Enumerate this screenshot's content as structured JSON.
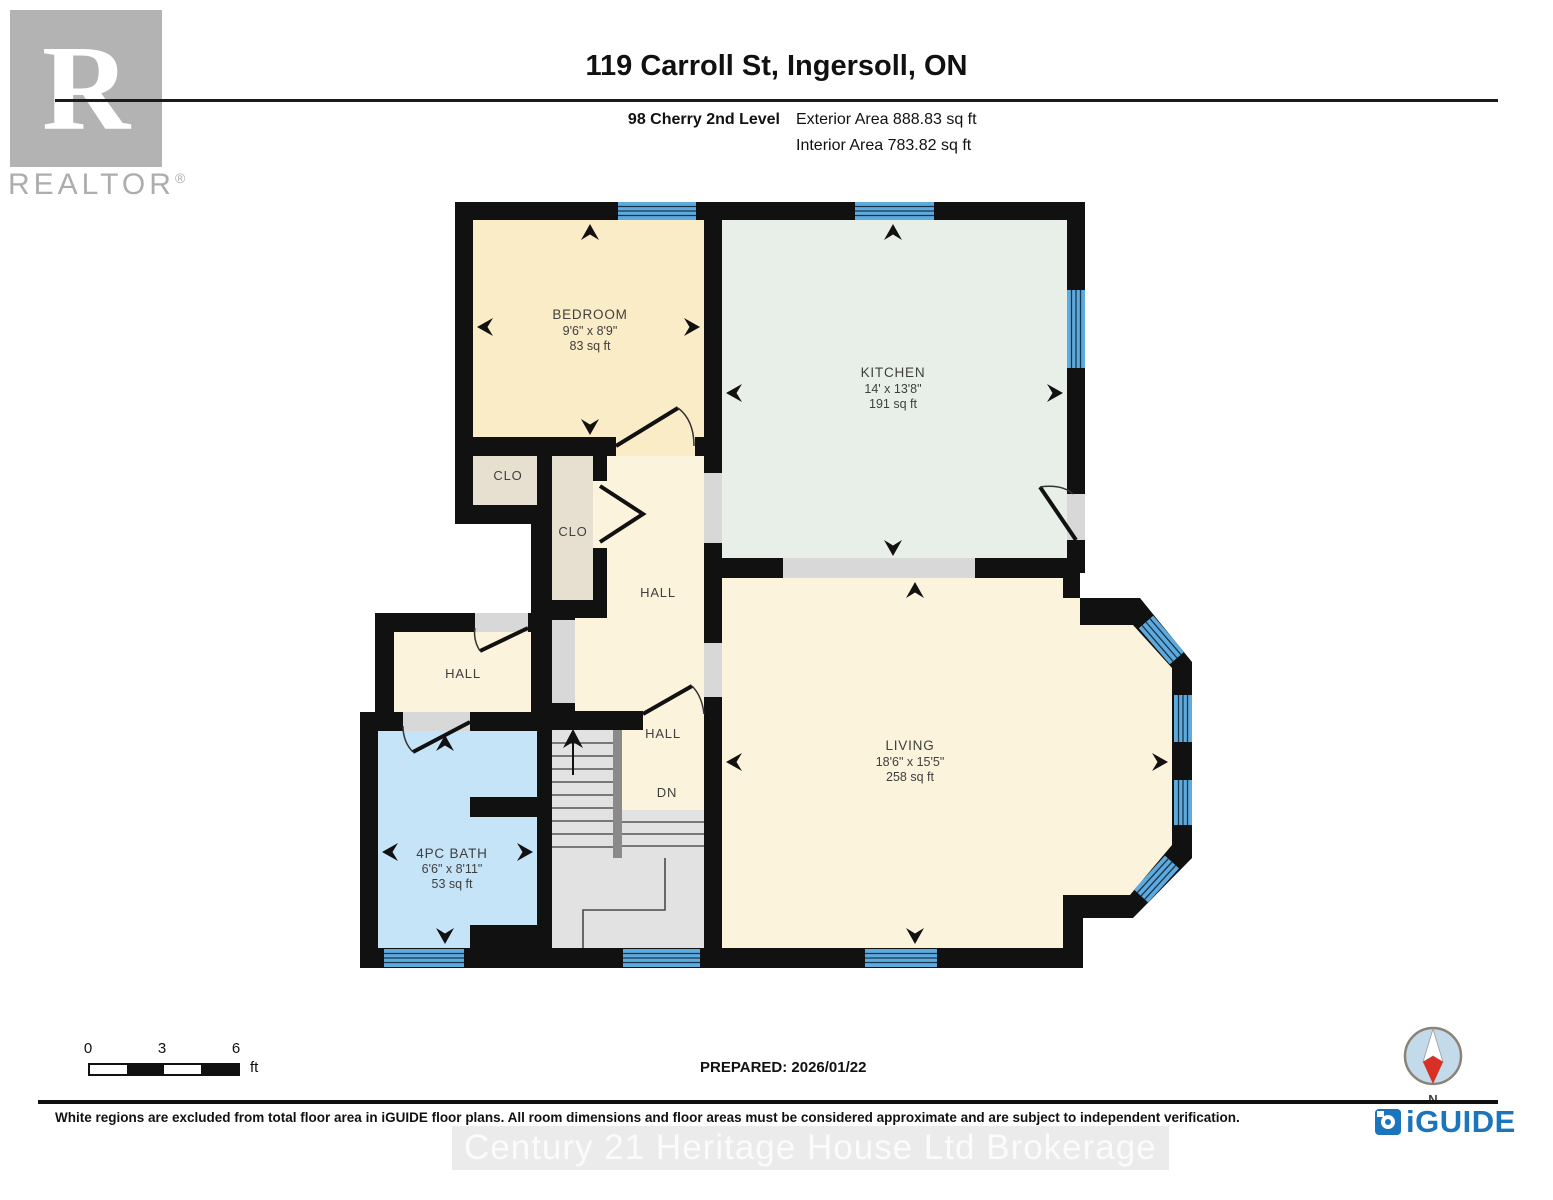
{
  "header": {
    "title": "119 Carroll St, Ingersoll, ON",
    "floor_label": "98 Cherry 2nd Level",
    "exterior_area": "Exterior Area 888.83 sq ft",
    "interior_area": "Interior Area 783.82 sq ft",
    "realtor_logo_letter": "R",
    "realtor_logo_text": "REALTOR",
    "registered_mark": "®"
  },
  "rooms": {
    "bedroom": {
      "name": "BEDROOM",
      "dims": "9'6\" x 8'9\"",
      "area": "83 sq ft"
    },
    "kitchen": {
      "name": "KITCHEN",
      "dims": "14' x 13'8\"",
      "area": "191 sq ft"
    },
    "living": {
      "name": "LIVING",
      "dims": "18'6\" x 15'5\"",
      "area": "258 sq ft"
    },
    "bath": {
      "name": "4PC BATH",
      "dims": "6'6\" x 8'11\"",
      "area": "53 sq ft"
    },
    "closet_small": {
      "name": "CLO"
    },
    "closet_tall": {
      "name": "CLO"
    },
    "hall_center": {
      "name": "HALL"
    },
    "hall_left": {
      "name": "HALL"
    },
    "hall_lower": {
      "name": "HALL"
    },
    "stairs_down": {
      "name": "DN"
    }
  },
  "scale_bar": {
    "tick_0": "0",
    "tick_3": "3",
    "tick_6": "6",
    "unit": "ft"
  },
  "compass": {
    "north_label": "N"
  },
  "footer": {
    "prepared": "PREPARED: 2026/01/22",
    "disclaimer": "White regions are excluded from total floor area in iGUIDE floor plans. All room dimensions and floor areas must be considered approximate and are subject to independent verification.",
    "brand": "iGUIDE",
    "watermark": "Century 21 Heritage House Ltd Brokerage"
  },
  "colors": {
    "wall": "#111111",
    "window": "#5FAADC",
    "bedroom_floor": "#FAECC6",
    "kitchen_floor": "#E8EFE8",
    "living_floor": "#FBF3DC",
    "closet_floor": "#E7E0D1",
    "bath_floor": "#C6E4F8",
    "opening": "#D8D8D8",
    "stairs": "#E2E2E2",
    "brand_blue": "#1B75BC",
    "compass_red": "#D93025"
  },
  "icons": {
    "compass": "compass-rose-icon",
    "brand": "iguide-camera-icon",
    "realtor": "realtor-r-logo"
  }
}
